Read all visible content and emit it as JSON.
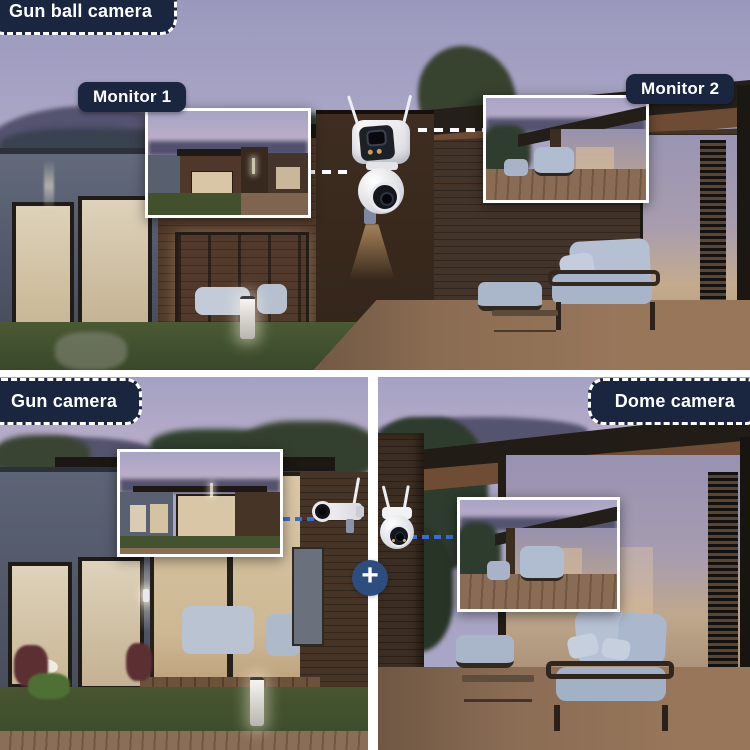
{
  "colors": {
    "annotation_navy": "#1a2540",
    "plus_badge_navy": "#2d4d7e",
    "connector_blue": "#3b6cd6",
    "connector_white": "#ffffff",
    "inset_border": "#ffffff",
    "label_text": "#ffffff"
  },
  "top_panel": {
    "tag": "Gun ball camera",
    "camera_icon": "dual-lens-gun-ball-camera-icon",
    "monitors": [
      {
        "label": "Monitor 1"
      },
      {
        "label": "Monitor 2"
      }
    ]
  },
  "bottom_left_panel": {
    "tag": "Gun camera",
    "camera_icon": "gun-bullet-camera-icon"
  },
  "bottom_right_panel": {
    "tag": "Dome camera",
    "camera_icon": "dome-ptz-camera-icon"
  },
  "combiner": {
    "symbol": "+"
  }
}
